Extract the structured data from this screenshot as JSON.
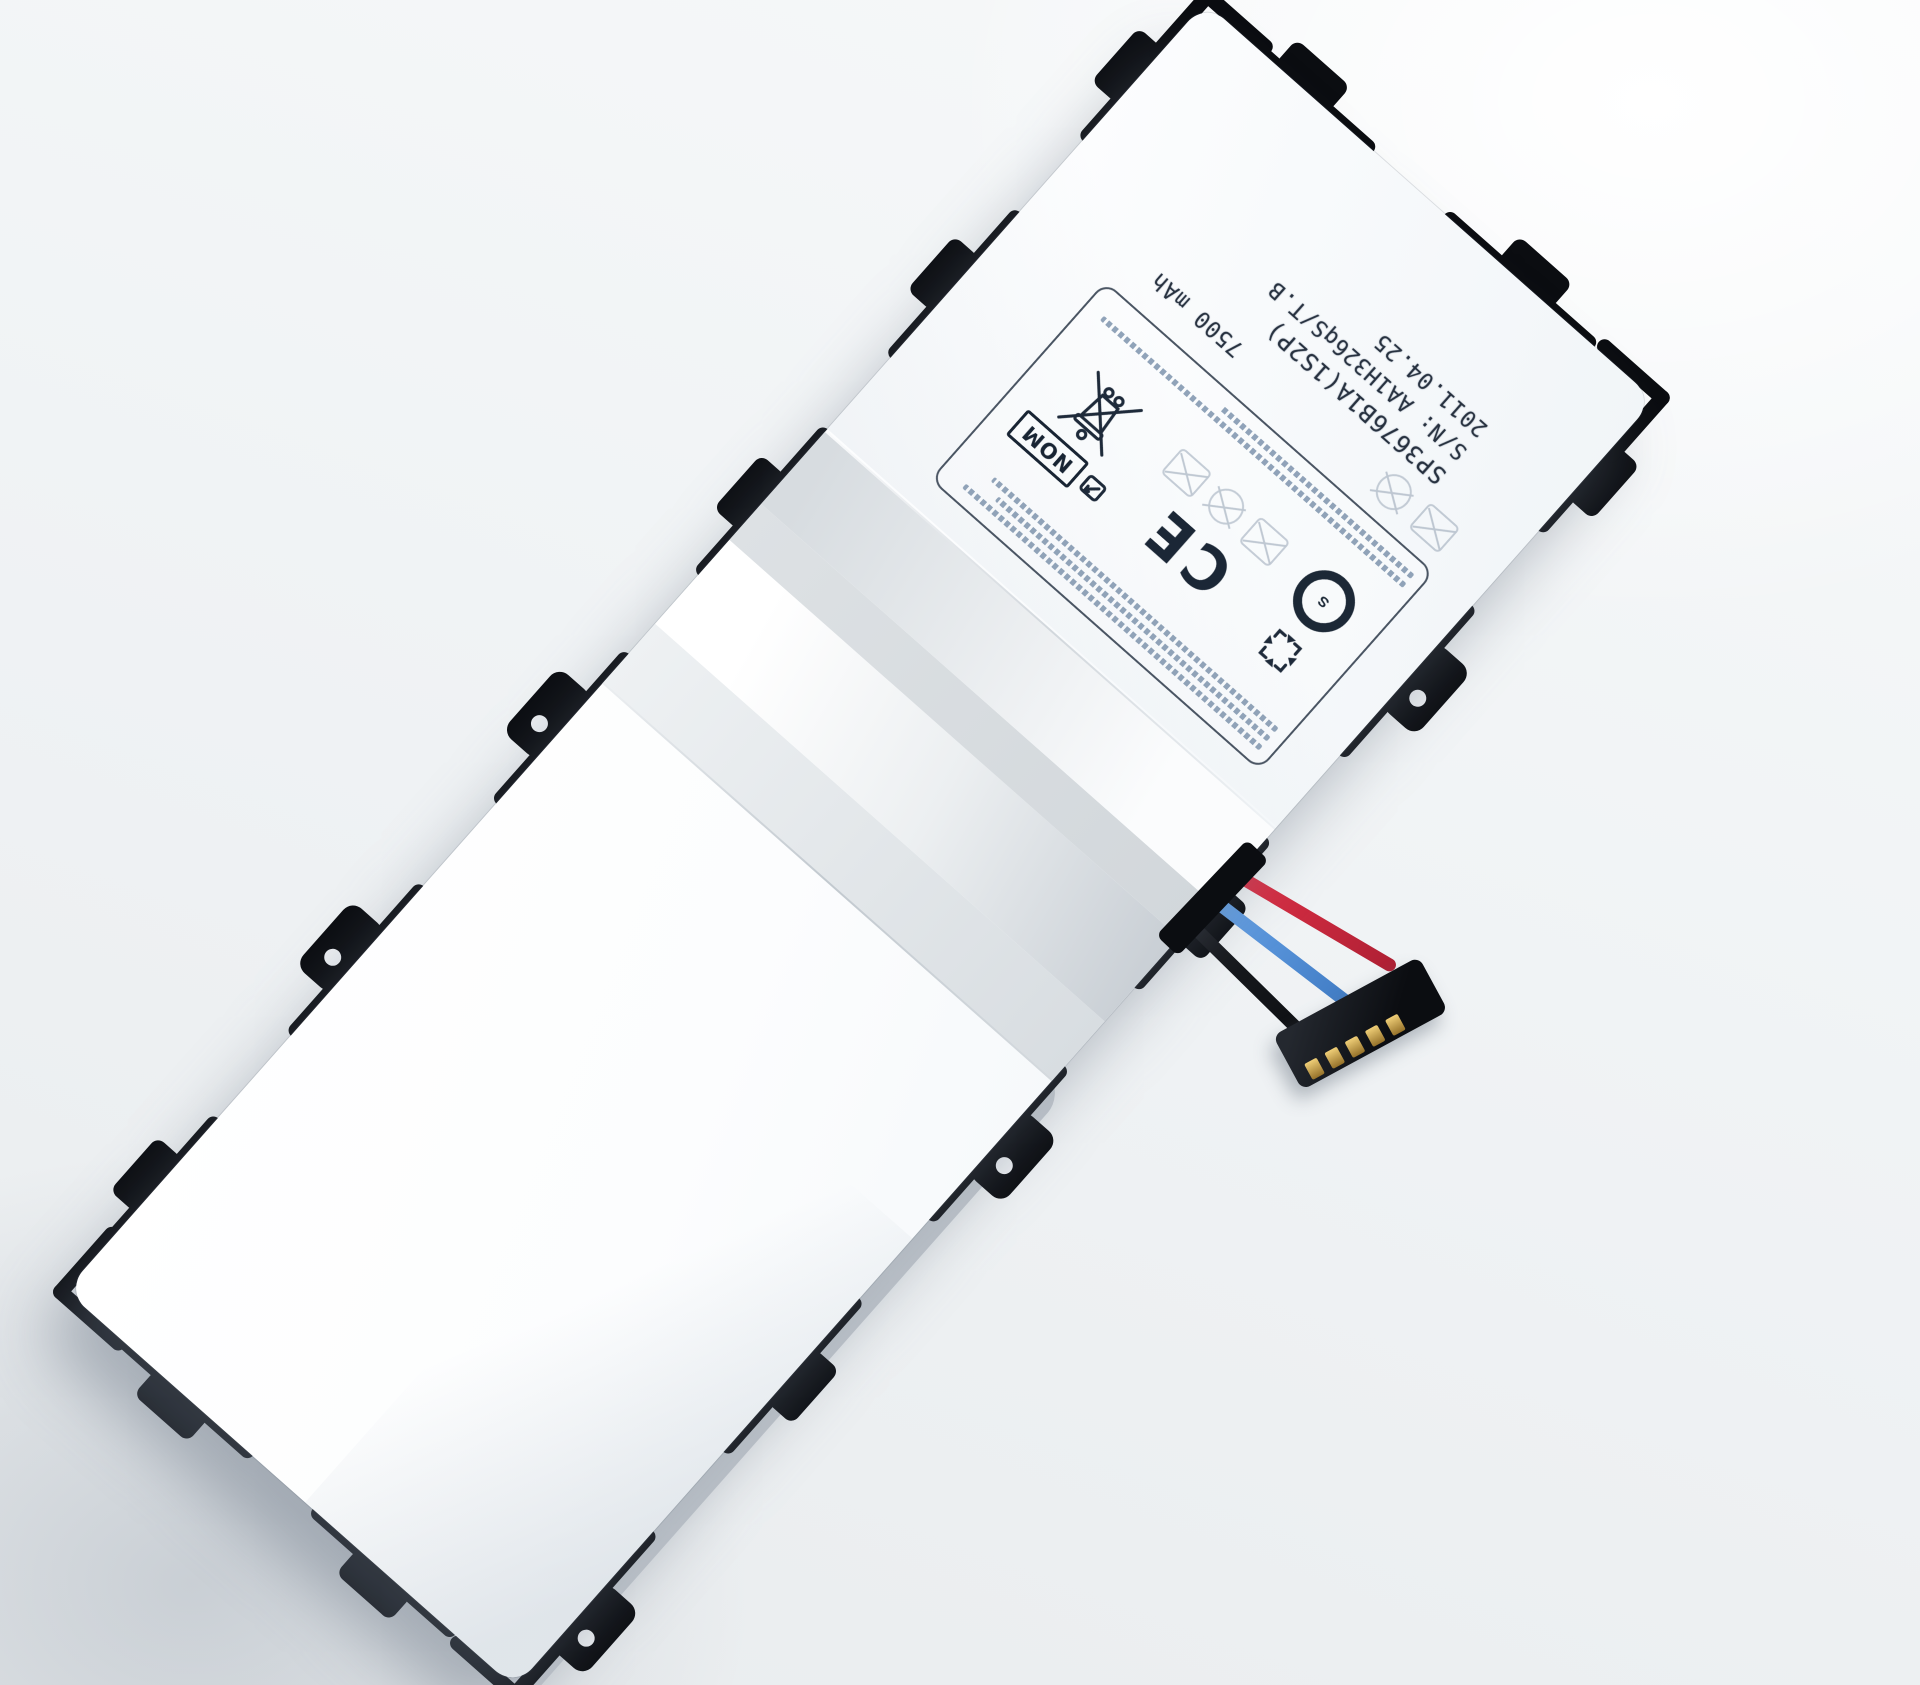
{
  "subject": "tablet battery pack product photo",
  "label": {
    "model_number": "SP3676B1A(1S2P)",
    "serial_number": "S/N: AA1H326qS/T.B",
    "manufacture_date": "2011.04.25",
    "capacity": "7500 mAh",
    "nom_mark": "NOM",
    "ce_mark": "CE",
    "s_mark": "S"
  },
  "marks": {
    "weee_bin": "crossed-out-wheeled-bin",
    "recycle": "four-arrow-recycle-square",
    "nom_pictogram": "certification-pictogram",
    "prohibition_icons": "faint crossed-out warning pictograms",
    "microtext": "illegible fine-print specification lines"
  },
  "connector": {
    "wire_colors": [
      "red",
      "blue",
      "black"
    ],
    "pin_count": 5
  },
  "colors": {
    "background": "#f3f5f7",
    "battery_body": "#fdfefe",
    "frame_black": "#0b0d11",
    "foil_silver": "#d7dce0",
    "label_ink": "#1e2a3a",
    "faint_ink": "#a7b3c1",
    "micro_ink": "#7d93ac",
    "wire_red": "#e23349",
    "wire_blue": "#5b9be4",
    "wire_black": "#15171b",
    "pin_gold": "#c9a24a"
  }
}
